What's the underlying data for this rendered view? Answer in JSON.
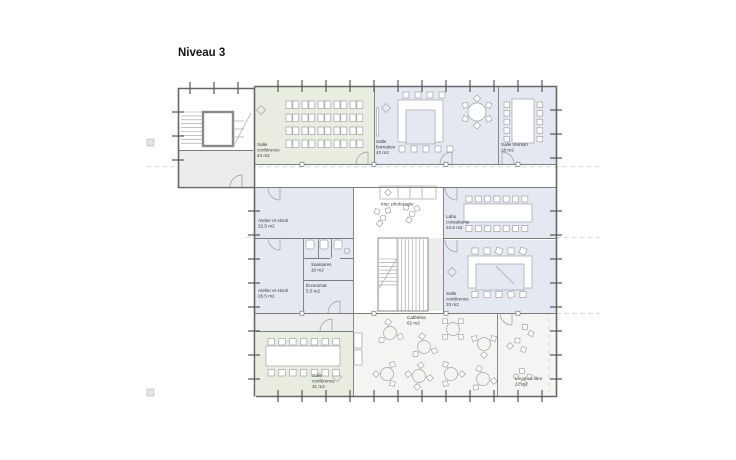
{
  "title": "Niveau 3",
  "rooms": {
    "conf44": {
      "l1": "Salle",
      "l2": "conférence",
      "l3": "44 m2"
    },
    "formation": {
      "l1": "Salle",
      "l2": "formation",
      "l3": "43 m2"
    },
    "reunion": {
      "l1": "Salle réunion",
      "l2": "18 m2"
    },
    "atelier1": {
      "l1": "Atelier et stock",
      "l2": "22.5 m2"
    },
    "atelier2": {
      "l1": "Atelier et stock",
      "l2": "26.5 m2"
    },
    "sanitaires": {
      "l1": "Sanitaires",
      "l2": "10 m2"
    },
    "economat": {
      "l1": "Économat",
      "l2": "5.5 m2"
    },
    "imp": {
      "l1": "Imp. photocopie"
    },
    "labo": {
      "l1": "Labo",
      "l2": "consultants",
      "l3": "24.5 m2"
    },
    "conf33": {
      "l1": "Salle",
      "l2": "conférence",
      "l3": "33 m2"
    },
    "cafeteria": {
      "l1": "Cafétéria",
      "l2": "62 m2"
    },
    "conf31": {
      "l1": "Salle",
      "l2": "conférence",
      "l3": "31 m2"
    },
    "libre": {
      "l1": "Local en libre",
      "l2": "22 m2"
    }
  },
  "colors": {
    "green": "#e9ede0",
    "blue": "#e3e8f1",
    "gray": "#ececec",
    "light": "#f4f4f2",
    "graylt": "#ededed",
    "wall": "#6a6a6a",
    "text": "#3b3b3b"
  }
}
